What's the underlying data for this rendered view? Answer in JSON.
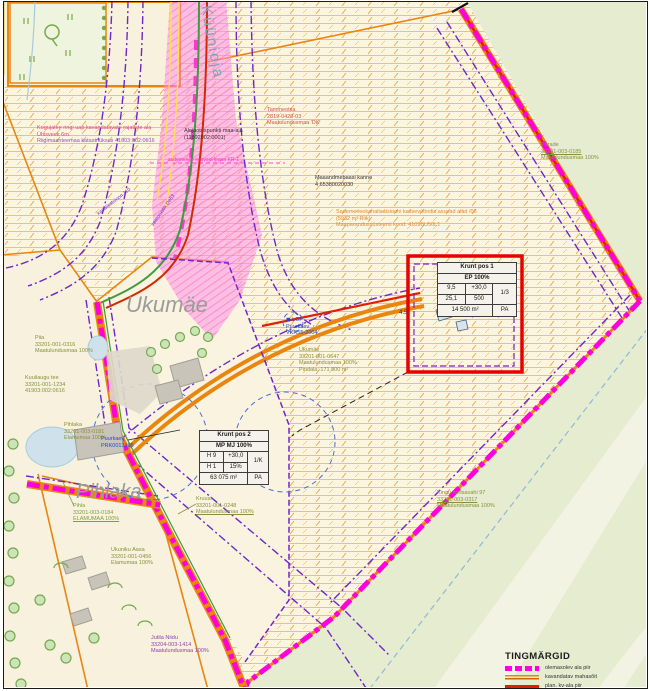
{
  "legend": {
    "title": "TINGMÄRGID",
    "items": [
      {
        "swatch": "magenta-dash",
        "label": "olemasolev ala piir"
      },
      {
        "swatch": "orange-line",
        "label": "kavandatav mahasõit"
      },
      {
        "swatch": "red-line",
        "label": "plan. kv-ala piir"
      },
      {
        "swatch": "mixed-dash",
        "label": "kavandatav tänavamaa"
      }
    ]
  },
  "tables": {
    "krunt1": {
      "title": "Krunt pos 1",
      "sub": "EP 100%",
      "c11": "9,5",
      "c12": "+30,0",
      "c13": "1/3",
      "c21": "25,1",
      "c22": "500",
      "area": "14 500 m²",
      "tag": "PA"
    },
    "krunt2": {
      "title": "Krunt pos 2",
      "sub": "MP MJ 100%",
      "c11": "H 9",
      "c12": "+30,0",
      "c13": "1/K",
      "c21": "H 1",
      "c22": "15%",
      "area": "63 075 m²",
      "tag": "PA"
    }
  },
  "labels": [
    {
      "id": "kuunioja",
      "lines": [
        "Küünioja"
      ],
      "x": 214,
      "y": 4,
      "color": "#7fa3b4",
      "size": 15,
      "rotate": 80,
      "spacing": 2
    },
    {
      "id": "roadnote",
      "lines": [
        "Kogujatee ringi uap kavandatavate rajatiste ala",
        "Ühisveek 6m",
        "Riigimaanteemaa katastriüksus 41903:002:0616"
      ],
      "line_colors": [
        "#e0447c",
        "#e0447c",
        "#8a56c8"
      ],
      "x": 37,
      "y": 125,
      "color": "#e0447c",
      "size": 5.5
    },
    {
      "id": "alajaotus",
      "lines": [
        "Alajaotuspunkti maa-ala",
        "(11892002:0001)"
      ],
      "x": 184,
      "y": 128,
      "color": "#333333",
      "size": 5.5
    },
    {
      "id": "tammeotsa",
      "lines": [
        "Tammeotsa",
        "2819-0420-03",
        "Maatulundusmaa 'DK'"
      ],
      "x": 267,
      "y": 107,
      "color": "#d9534f",
      "size": 5.5
    },
    {
      "id": "maaandmebaas",
      "lines": [
        "Maaandmebaasi kanne",
        "4 65380020030"
      ],
      "x": 315,
      "y": 175,
      "color": "#333333",
      "size": 5.5
    },
    {
      "id": "sademevee",
      "lines": [
        "Sademeveekanalisatsiooni kaitsevööndis asuvad alad /06",
        "(5932 m² Riik)",
        "Maaparandussüsteemi kood: 4109BU50L1"
      ],
      "x": 336,
      "y": 209,
      "color": "#e8882a",
      "size": 5.5
    },
    {
      "id": "parade",
      "lines": [
        "Pärade",
        "33201-003-0185",
        "Maatulundusmaa 100%"
      ],
      "underline": [
        1
      ],
      "x": 541,
      "y": 142,
      "color": "#8a8f3c",
      "size": 5.5
    },
    {
      "id": "ukumae-info",
      "lines": [
        "Ukumäe",
        "33201-001-0647",
        "Maatulundusmaa 100%",
        "Pindala: 171 800 m²"
      ],
      "x": 299,
      "y": 347,
      "color": "#8a8f3c",
      "size": 5.5
    },
    {
      "id": "lop",
      "lines": [
        "◼ LOP",
        "Puurkaev",
        "VKR55-2004"
      ],
      "x": 286,
      "y": 317,
      "color": "#2749c9",
      "size": 5.5
    },
    {
      "id": "ukumae-title",
      "lines": [
        "Ukumäe"
      ],
      "x": 126,
      "y": 292,
      "color": "#9b9b9b",
      "size": 22,
      "italic": true
    },
    {
      "id": "pihlaka-title",
      "lines": [
        "Pihlaka"
      ],
      "x": 76,
      "y": 480,
      "color": "#9b9b9b",
      "size": 20,
      "italic": true
    },
    {
      "id": "pihlaka-info",
      "lines": [
        "Pihlaka",
        "33201-003-0181",
        "Elamumaa 100%"
      ],
      "x": 64,
      "y": 422,
      "color": "#8a8f3c",
      "size": 5.5
    },
    {
      "id": "puurkaev2",
      "lines": [
        "Puurkaev",
        "PRK0013195"
      ],
      "x": 101,
      "y": 436,
      "color": "#2749c9",
      "size": 5.5
    },
    {
      "id": "pihla-info",
      "lines": [
        "Pihla",
        "33201-003-0184",
        "ELAMUMAA 100%"
      ],
      "underline": [
        2
      ],
      "x": 73,
      "y": 503,
      "color": "#7ca03c",
      "size": 5.5
    },
    {
      "id": "kruusi-info",
      "lines": [
        "Kruusi",
        "33201-001-0248",
        "Maatulundusmaa 100%"
      ],
      "underline": [
        2
      ],
      "x": 196,
      "y": 496,
      "color": "#8a8f3c",
      "size": 5.5
    },
    {
      "id": "ukuniku-aasa",
      "lines": [
        "Ukuniku Aasa",
        "33201-001-0456",
        "Elamumaa 100%"
      ],
      "x": 111,
      "y": 547,
      "color": "#8a8f3c",
      "size": 5.5
    },
    {
      "id": "jutila",
      "lines": [
        "Jutila Niidu",
        "33204-003-1414",
        "Maatulundusmaa 100%"
      ],
      "x": 151,
      "y": 635,
      "color": "#8e44ad",
      "size": 5.5
    },
    {
      "id": "kingu",
      "lines": [
        "Kingu metsavahi 97",
        "33201-003-0317",
        "Maatulundusmaa 100%"
      ],
      "underline": [
        1
      ],
      "x": 437,
      "y": 490,
      "color": "#8a8f3c",
      "size": 5.5
    },
    {
      "id": "piia",
      "lines": [
        "Piia",
        "33201-001-0316",
        "Maatulundusmaa 100%"
      ],
      "x": 35,
      "y": 335,
      "color": "#8a8f3c",
      "size": 5.5
    },
    {
      "id": "kuuliaugu",
      "lines": [
        "Kuuliaugu tee",
        "33201-001-1234",
        "41903:002:0616"
      ],
      "x": 25,
      "y": 375,
      "color": "#8a8f3c",
      "size": 5.5
    },
    {
      "id": "dim-45",
      "lines": [
        "4.5"
      ],
      "x": 399,
      "y": 310,
      "color": "#333333",
      "size": 6
    },
    {
      "id": "kraav-note",
      "lines": [
        "sademevee eesvool kraav KR-1"
      ],
      "x": 168,
      "y": 157,
      "color": "#ff2fd0",
      "size": 5
    },
    {
      "id": "toru1",
      "lines": [
        "kanalisatsioon 110"
      ],
      "x": 96,
      "y": 212,
      "color": "#7a2fc9",
      "size": 5,
      "rotate": -38
    },
    {
      "id": "toru2",
      "lines": [
        "veetorustik De63"
      ],
      "x": 150,
      "y": 224,
      "color": "#7a2fc9",
      "size": 5,
      "rotate": -55
    }
  ],
  "colors": {
    "boundary_magenta": "#ff00dd",
    "road_orange": "#e8860f",
    "plan_red": "#e02000",
    "utility_purple": "#6d28c9",
    "forest_green": "#e6eccf",
    "hatch_orange": "#ecaf58",
    "corridor_pink": "#ff8ce0"
  }
}
